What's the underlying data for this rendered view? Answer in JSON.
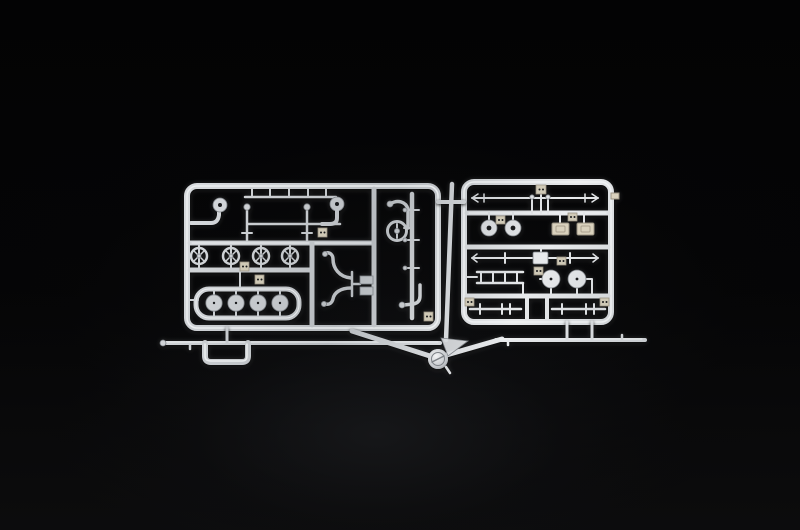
{
  "scene": {
    "description": "Studio photograph of an unpainted light-grey injection-moulded plastic model-kit sprue (parts tree) lying on a black background",
    "background": "black backdrop with faint soft light pooling near the lower centre",
    "object": "two rectangular sprue frames joined by a vertical runner and a V-shaped gate with a round injection knob"
  },
  "colors": {
    "plastic": "#c6c9cd",
    "plastic_light": "#f1f3f5",
    "plastic_dark": "#7e8287",
    "plastic_beige": "#d9d1bd",
    "beige_edge": "#9a9384",
    "tag_beige": "#cfc9b6",
    "hole": "#1a1b1d"
  },
  "left_sprue": {
    "label": "left sprue frame with piping and wheel parts",
    "parts": {
      "curved_pipe_with_flange": "curved pipe ending in a round flange disc (two of these in the top row)",
      "tie_rods": "straight rods clipped to the frame top with small gate ticks",
      "valve_wheels": "row of four small spoked hand-wheels on a runner",
      "pulley_boat": "boat-shaped loop holding four round pulley wheels",
      "fork_part": "twin-horn fork / handlebar part with two rectangular pads",
      "j_pipe": "J-shaped pipe with ball end",
      "ring_part": "ring with a small pin inside",
      "elbow_pipe": "elbow pipe with ball end in lower right cell",
      "number_tags": "small moulded part-number tags (digits too small to read)"
    }
  },
  "right_sprue": {
    "label": "right sprue frame with axles and wheel parts",
    "parts": {
      "long_axle": "long thin axle rod with tapered arrow-like ends",
      "round_discs": "two small round discs with hub holes",
      "bevelled_plates": "two cream rectangular plates with recessed centres",
      "second_axle": "second axle rod with a square centre block",
      "ladder_part": "ladder-shaped frame piece with rungs",
      "road_wheels": "two hubbed road wheels above a runner",
      "coupling_rods": "two short rods with T and H shaped couplers in the bottom cells",
      "number_tags": "small moulded part-number tags (digits too small to read)"
    }
  },
  "runner_system": {
    "label": "feed runners and injection gate",
    "parts": {
      "left_feed_bar": "long thin feed bar under the left frame",
      "u_bracket": "U-shaped bracket hanging from the left feed bar",
      "gate_knob": "round injection-gate knob at the V junction",
      "v_arms": "two diagonal gate arms forming a V",
      "inter_frame_runner": "near-vertical runner between the two frames",
      "right_feed_bar": "feed bar under the right frame joined by two stubs"
    }
  }
}
